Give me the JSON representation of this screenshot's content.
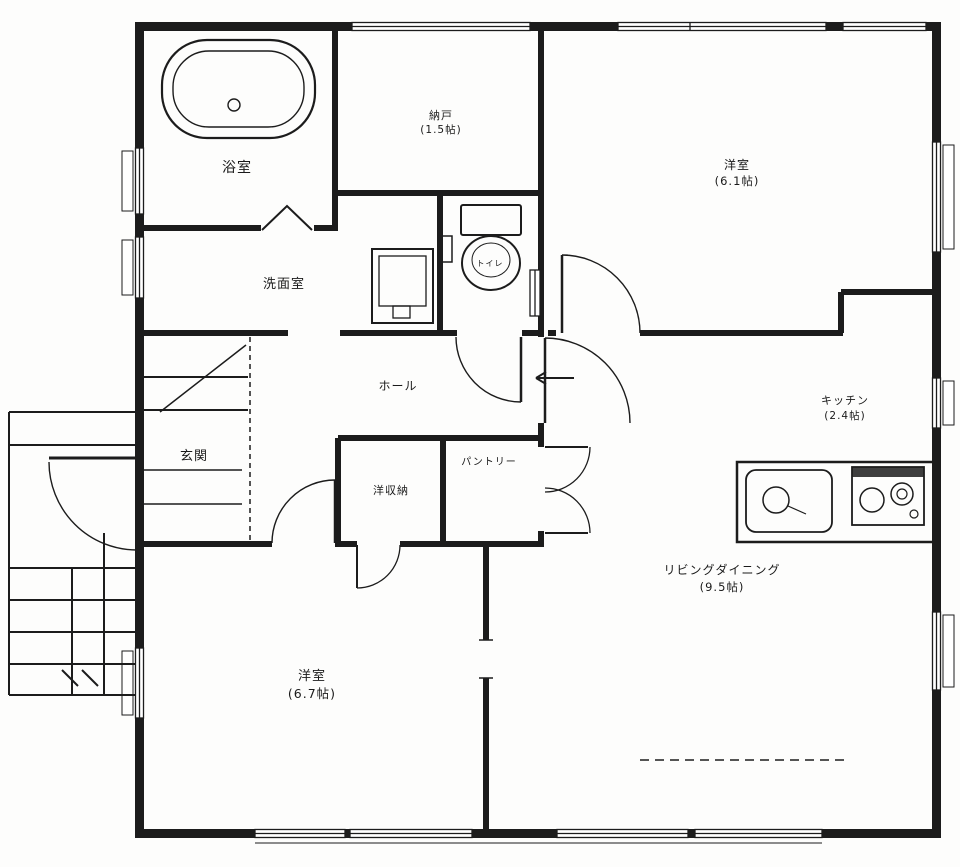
{
  "colors": {
    "line": "#1c1c1c",
    "background": "#fdfdfc"
  },
  "rooms": {
    "bathroom": {
      "name": "浴室"
    },
    "storage": {
      "name": "納戸",
      "size": "(1.5帖)"
    },
    "bedroom_ne": {
      "name": "洋室",
      "size": "(6.1帖)"
    },
    "washroom": {
      "name": "洗面室"
    },
    "toilet": {
      "name": "トイレ"
    },
    "hall": {
      "name": "ホール"
    },
    "entrance": {
      "name": "玄関"
    },
    "closet": {
      "name": "洋収納"
    },
    "pantry": {
      "name": "パントリー"
    },
    "kitchen": {
      "name": "キッチン",
      "size": "(2.4帖)"
    },
    "living_dining": {
      "name": "リビングダイニング",
      "size": "(9.5帖)"
    },
    "bedroom_sw": {
      "name": "洋室",
      "size": "(6.7帖)"
    }
  }
}
